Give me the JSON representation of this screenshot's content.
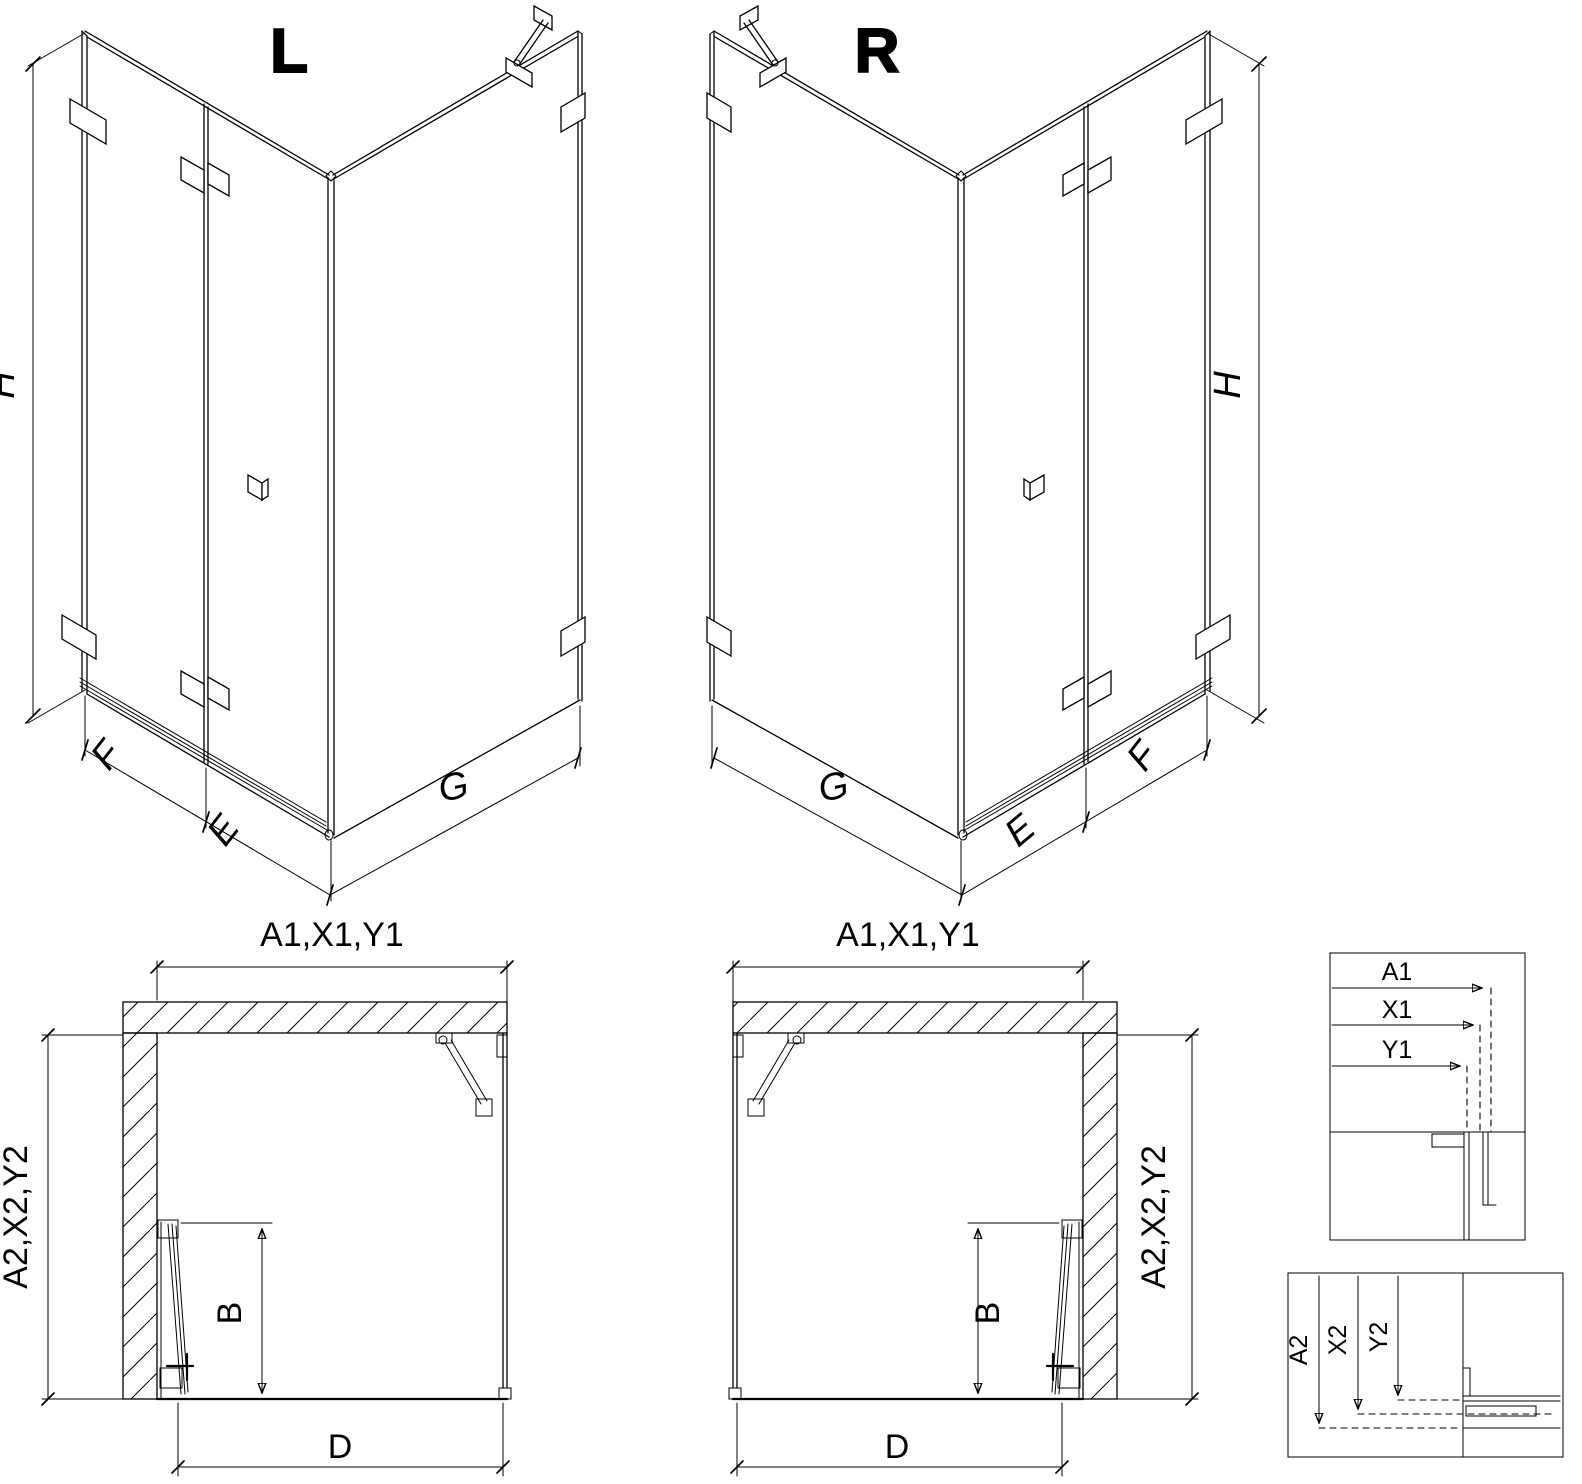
{
  "page": {
    "background": "#ffffff",
    "line_color": "#000000",
    "description": "Corner shower enclosure technical drawing, L and R variants"
  },
  "iso_left": {
    "label": "L",
    "dim_h": "H",
    "dim_f": "F",
    "dim_e": "E",
    "dim_g": "G"
  },
  "iso_right": {
    "label": "R",
    "dim_h": "H",
    "dim_g": "G",
    "dim_e": "E",
    "dim_f": "F"
  },
  "plan_left": {
    "dim_width": "A1,X1,Y1",
    "dim_depth": "A2,X2,Y2",
    "dim_b": "B",
    "dim_d": "D"
  },
  "plan_right": {
    "dim_width": "A1,X1,Y1",
    "dim_depth": "A2,X2,Y2",
    "dim_b": "B",
    "dim_d": "D"
  },
  "detail_width": {
    "dim_a1": "A1",
    "dim_x1": "X1",
    "dim_y1": "Y1"
  },
  "detail_depth": {
    "dim_a2": "A2",
    "dim_x2": "X2",
    "dim_y2": "Y2"
  }
}
